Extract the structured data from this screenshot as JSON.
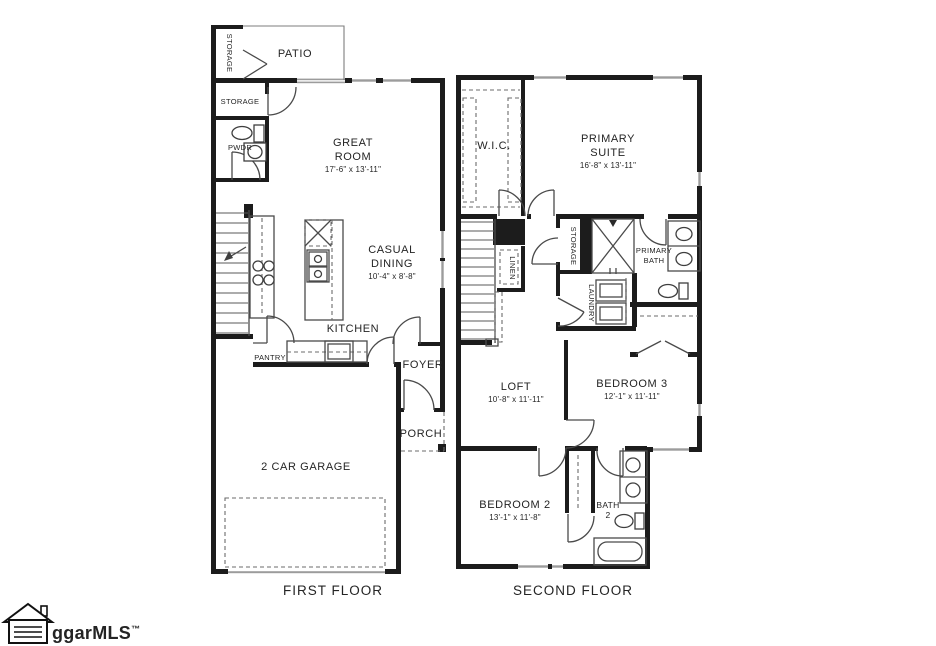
{
  "floor1": {
    "floor_label": "FIRST FLOOR",
    "patio": {
      "label": "PATIO"
    },
    "patio_storage": {
      "label": "STORAGE"
    },
    "storage": {
      "label": "STORAGE"
    },
    "pwdr": {
      "label": "PWDR"
    },
    "great_room": {
      "line1": "GREAT",
      "line2": "ROOM",
      "dims": "17'-6\" x 13'-11\""
    },
    "casual_dining": {
      "line1": "CASUAL",
      "line2": "DINING",
      "dims": "10'-4\" x 8'-8\""
    },
    "kitchen": {
      "label": "KITCHEN"
    },
    "pantry": {
      "label": "PANTRY"
    },
    "foyer": {
      "label": "FOYER"
    },
    "porch": {
      "label": "PORCH"
    },
    "garage": {
      "label": "2 CAR GARAGE"
    }
  },
  "floor2": {
    "floor_label": "SECOND FLOOR",
    "wic": {
      "label": "W.I.C."
    },
    "primary_suite": {
      "line1": "PRIMARY",
      "line2": "SUITE",
      "dims": "16'-8\" x 13'-11\""
    },
    "storage": {
      "label": "STORAGE"
    },
    "linen": {
      "label": "LINEN"
    },
    "laundry": {
      "label": "LAUNDRY"
    },
    "primary_bath": {
      "line1": "PRIMARY",
      "line2": "BATH"
    },
    "loft": {
      "line1": "LOFT",
      "dims": "10'-8\" x 11'-11\""
    },
    "bedroom3": {
      "line1": "BEDROOM 3",
      "dims": "12'-1\" x 11'-11\""
    },
    "bedroom2": {
      "line1": "BEDROOM 2",
      "dims": "13'-1\" x 11'-8\""
    },
    "bath2": {
      "line1": "BATH",
      "line2": "2"
    }
  },
  "watermark": {
    "text": "ggarMLS",
    "tm": "™"
  },
  "colors": {
    "wall": "#1c1c1c",
    "window": "#9c9c9c",
    "text": "#242424",
    "background": "#ffffff"
  }
}
